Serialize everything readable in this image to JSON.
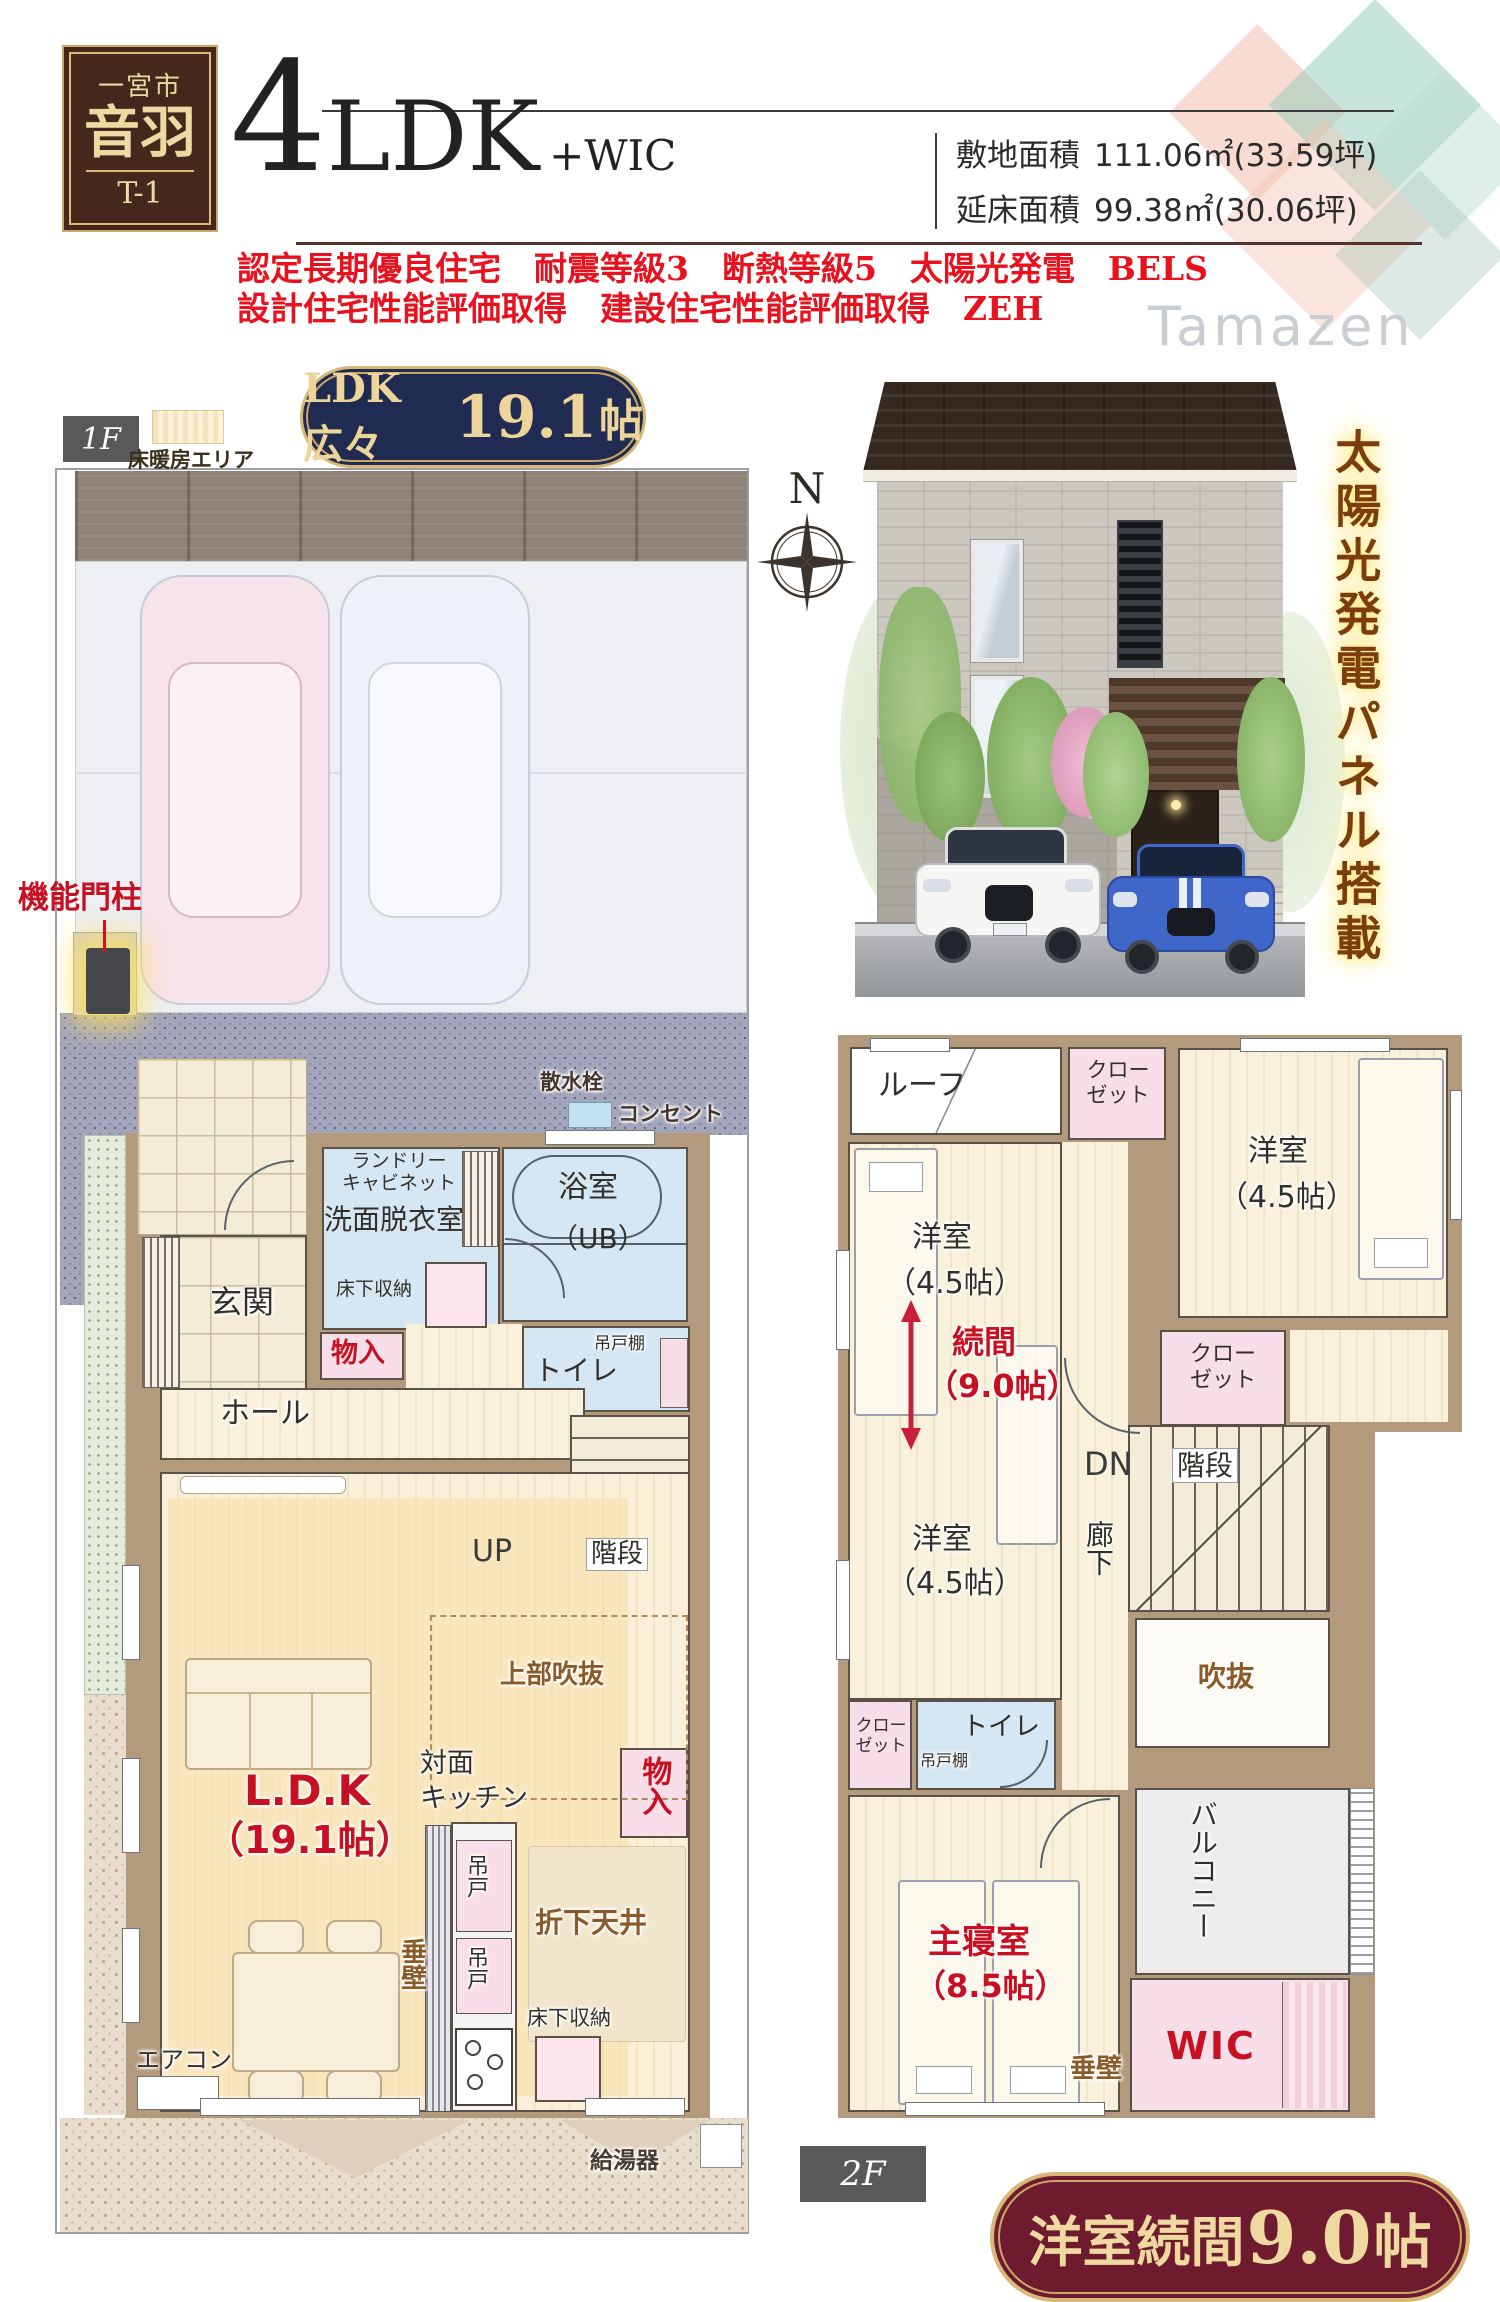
{
  "header": {
    "city": "一宮市",
    "name": "音羽",
    "unit": "T-1",
    "plan_num": "4",
    "plan_rest": "LDK",
    "plan_suffix": "+WIC",
    "site_label": "敷地面積",
    "site_value": "111.06㎡(33.59坪)",
    "floor_label": "延床面積",
    "floor_value": "99.38㎡(30.06坪)",
    "features1": "認定長期優良住宅　耐震等級3　断熱等級5　太陽光発電　BELS",
    "features2": "設計住宅性能評価取得　建設住宅性能評価取得　ZEH",
    "brand": "Tamazen"
  },
  "badges": {
    "ldk_prefix": "LDK広々",
    "ldk_value": "19.1",
    "ldk_unit": "帖",
    "zoku_prefix": "洋室続間",
    "zoku_value": "9.0",
    "zoku_unit": "帖"
  },
  "labels": {
    "f1": "1F",
    "f2": "2F",
    "floor_heating": "床暖房エリア",
    "north": "N",
    "solar": "太陽光発電パネル搭載",
    "gate_post": "機能門柱",
    "sprinkler": "散水栓",
    "outlet": "コンセント",
    "water_heater": "給湯器",
    "aircon": "エアコン"
  },
  "f1": {
    "genkan": "玄関",
    "hall": "ホール",
    "laundry_cabinet": "ランドリー\nキャビネット",
    "washroom": "洗面脱衣室",
    "underfloor": "床下収納",
    "bath": "浴室",
    "bath_ub": "（UB）",
    "toilet": "トイレ",
    "hanging_shelf": "吊戸棚",
    "storage": "物入",
    "up": "UP",
    "stairs": "階段",
    "void_above": "上部吹抜",
    "ldk": "L.D.K",
    "ldk_size": "（19.1帖）",
    "kitchen": "対面\nキッチン",
    "hanging_door": "吊戸",
    "tarekabe": "垂壁",
    "dropped_ceiling": "折下天井",
    "storage2": "物入"
  },
  "f2": {
    "roof": "ルーフ",
    "closet": "クロー\nゼット",
    "bedroom": "洋室",
    "bedroom_size": "（4.5帖）",
    "zokuma": "続間",
    "zokuma_size": "（9.0帖）",
    "dn": "DN",
    "stairs": "階段",
    "hallway": "廊下",
    "void": "吹抜",
    "toilet": "トイレ",
    "hanging_shelf": "吊戸棚",
    "balcony": "バルコニー",
    "master": "主寝室",
    "master_size": "（8.5帖）",
    "tarekabe": "垂壁",
    "wic": "WIC"
  }
}
